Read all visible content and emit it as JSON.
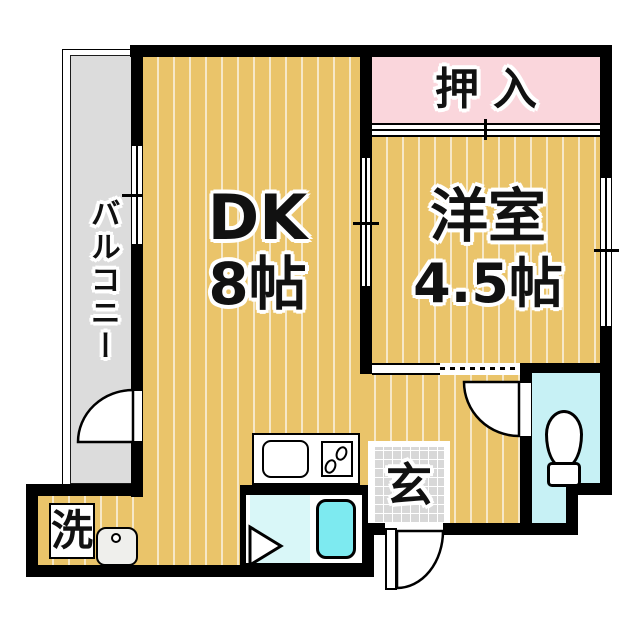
{
  "plan": {
    "balcony": {
      "label": "バルコニー"
    },
    "dk": {
      "name": "DK",
      "size": "8帖"
    },
    "closet": {
      "label": "押入"
    },
    "western_room": {
      "name": "洋室",
      "size": "4.5帖"
    },
    "entrance": {
      "label": "玄"
    },
    "laundry": {
      "label": "洗"
    }
  },
  "colors": {
    "wall": "#000000",
    "floor": "#eac46a",
    "floor_stripe": "#f6e8c8",
    "closet_pink": "#fad6dc",
    "balcony_gray": "#dcdcdc",
    "entrance_tile": "#d8d8d8",
    "toilet_room": "#c7f1f5",
    "bath_floor": "#d9f7f8",
    "bathtub": "#7deaf0"
  },
  "icons": {
    "kitchen_sink": "kitchen-sink-icon",
    "stove": "stove-burners-icon",
    "wash_basin": "wash-basin-icon",
    "toilet": "toilet-icon",
    "bathtub": "bathtub-icon",
    "door_swing": "door-swing-icon",
    "bath_door": "bath-door-triangle-icon"
  }
}
